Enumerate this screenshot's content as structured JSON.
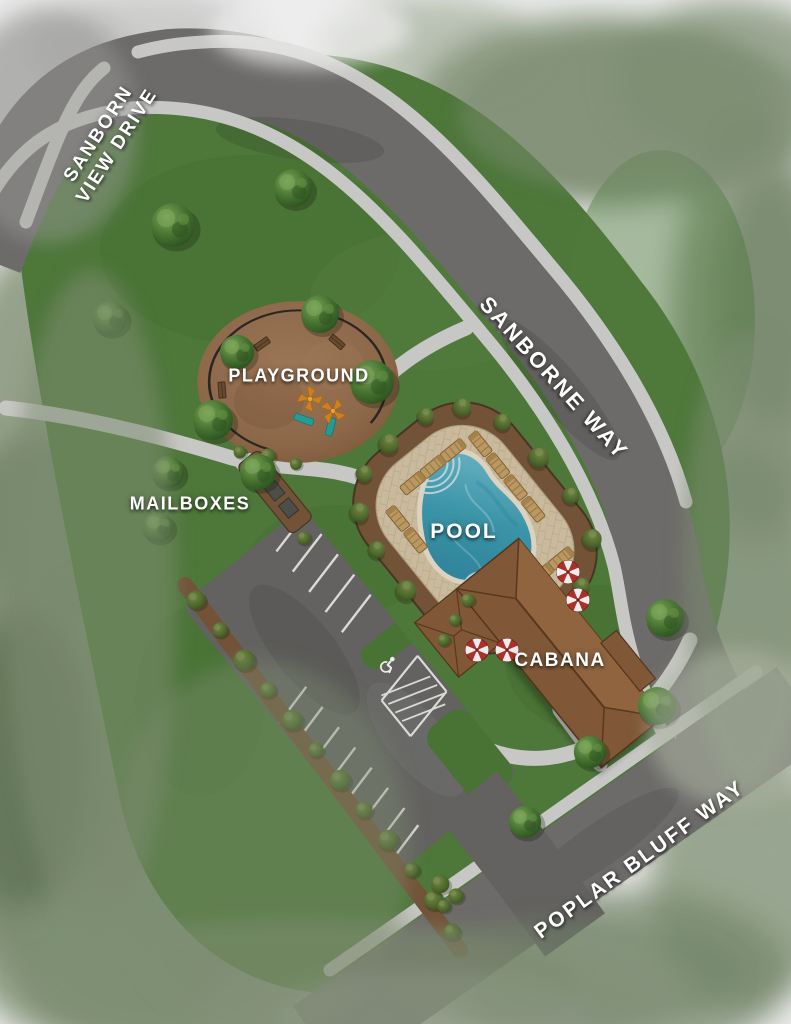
{
  "map": {
    "type": "community-amenity-site-plan",
    "roads": {
      "sanborn_view_drive": {
        "line1": "SANBORN",
        "line2": "VIEW DRIVE"
      },
      "sanborne_way": "SANBORNE WAY",
      "poplar_bluff_way": "POPLAR BLUFF WAY"
    },
    "amenities": {
      "playground": "PLAYGROUND",
      "mailboxes": "MAILBOXES",
      "pool": "POOL",
      "cabana": "CABANA"
    },
    "icons": {
      "accessible_parking": "wheelchair-symbol",
      "umbrella": "red-white-striped-parasol",
      "lounge_chair": "wood-slat-chaise",
      "playground_equipment": "orange-canopy-and-teal-slides"
    },
    "colors": {
      "grass": "#54803f",
      "road": "#767472",
      "parking_asphalt": "#6b6a68",
      "sidewalk": "#d7d7d4",
      "stripe_white": "#ebebe7",
      "playground_mulch": "#97704f",
      "landscape_mulch": "#7b5a3d",
      "pool_water": "#3f9fb4",
      "pool_deck": "#d9c9ab",
      "pool_coping": "#ece4cf",
      "cabana_roof": "#8a5f3c",
      "umbrella_red": "#b9352e",
      "tree_green": "#4e7d36",
      "watercolor_edge": "#87987a",
      "label_text": "#ffffff"
    }
  }
}
